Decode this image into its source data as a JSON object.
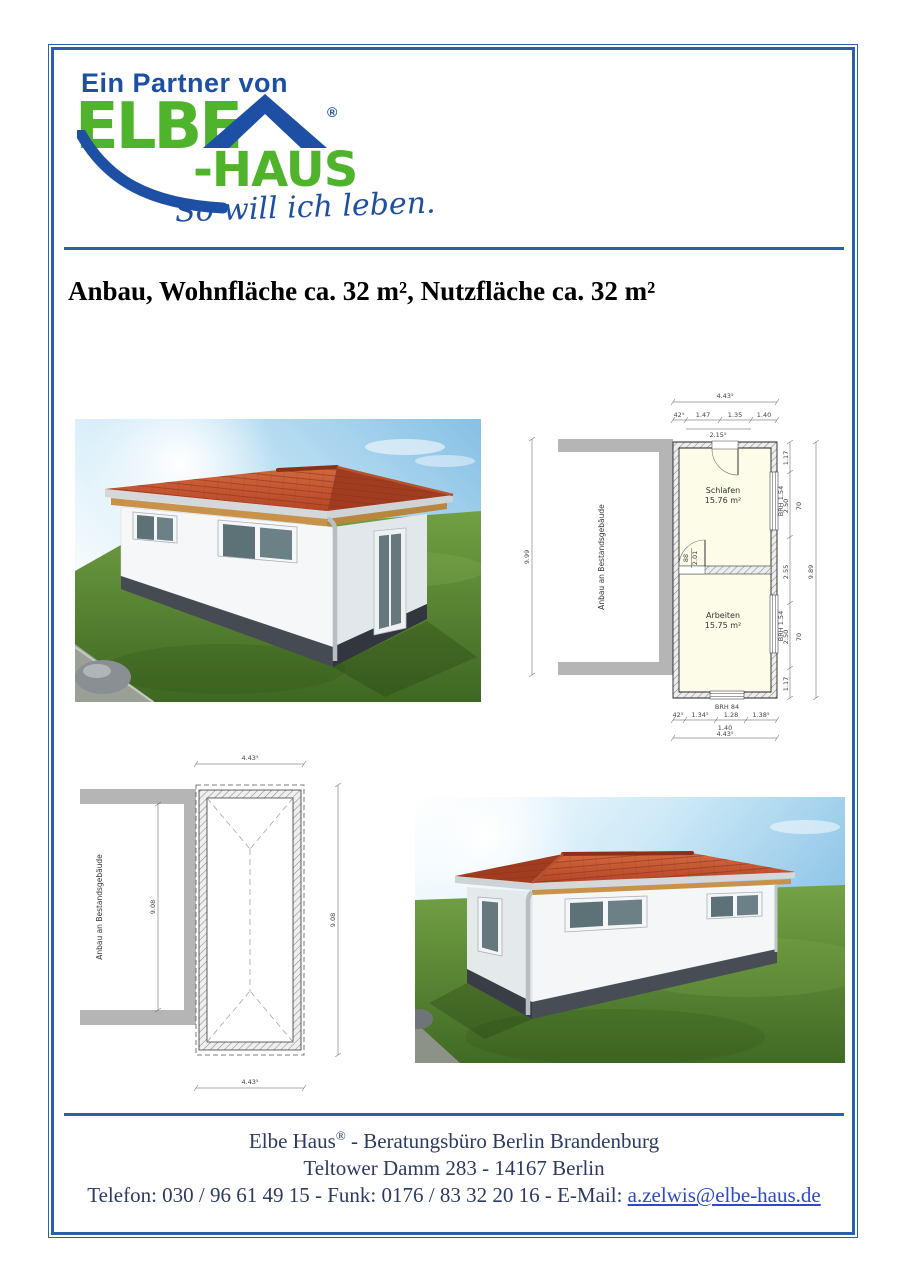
{
  "logo": {
    "partner_text": "Ein Partner von",
    "brand_top": "ELBE",
    "brand_bottom": "-HAUS",
    "registered_mark": "®",
    "slogan": "So will ich leben."
  },
  "title": "Anbau, Wohnfläche ca. 32 m², Nutzfläche ca. 32 m²",
  "colors": {
    "border_blue": "#2e5ea8",
    "logo_green": "#4fb42c",
    "logo_blue": "#1d50a5",
    "roof_red": "#c04a2f",
    "plinth_gray": "#474c55",
    "grass_green": "#527e2e",
    "plan_room_fill": "#fcfce9",
    "plan_gray": "#b5b5b5",
    "footer_text": "#2d3a64",
    "link_blue": "#2f49c4"
  },
  "floorplan_upper": {
    "existing_building_label": "Anbau an Bestandsgebäude",
    "rooms": [
      {
        "name": "Schlafen",
        "area": "15.76 m²"
      },
      {
        "name": "Arbeiten",
        "area": "15.75 m²"
      }
    ],
    "door": {
      "width": "88",
      "height": "2.01"
    },
    "dims": {
      "top_total": "4.43⁵",
      "top_segments": [
        "42⁵",
        "1.47",
        "1.35",
        "1.40"
      ],
      "top_sub": "2.15⁵",
      "left_total": "9.99",
      "right_total": "9.89",
      "right_segments": [
        "1.17",
        "2.50",
        "2.55",
        "2.50",
        "1.17"
      ],
      "right_sills": [
        "BRH 1.54",
        "BRH 1.54"
      ],
      "right_window_heights": [
        "70",
        "70"
      ],
      "bottom_sill": "BRH 84",
      "bottom_segments": [
        "42⁵",
        "1.34⁵",
        "1.28",
        "1.38⁵"
      ],
      "bottom_sub": "1.40",
      "bottom_total": "4.43⁵"
    }
  },
  "floorplan_lower": {
    "existing_building_label": "Anbau an Bestandsgebäude",
    "dims": {
      "top_total": "4.43⁵",
      "bottom_total": "4.43⁵",
      "middle_vertical": "9.08",
      "right_vertical": "9.08"
    }
  },
  "footer": {
    "line1_name": "Elbe Haus",
    "line1_mark": "®",
    "line1_rest": "  -  Beratungsbüro Berlin Brandenburg",
    "line2": "Teltower Damm 283  -  14167 Berlin",
    "line3_prefix": "Telefon: 030 / 96 61 49 15  -  Funk: 0176 / 83 32 20 16  -  E-Mail: ",
    "email": "a.zelwis@elbe-haus.de"
  }
}
